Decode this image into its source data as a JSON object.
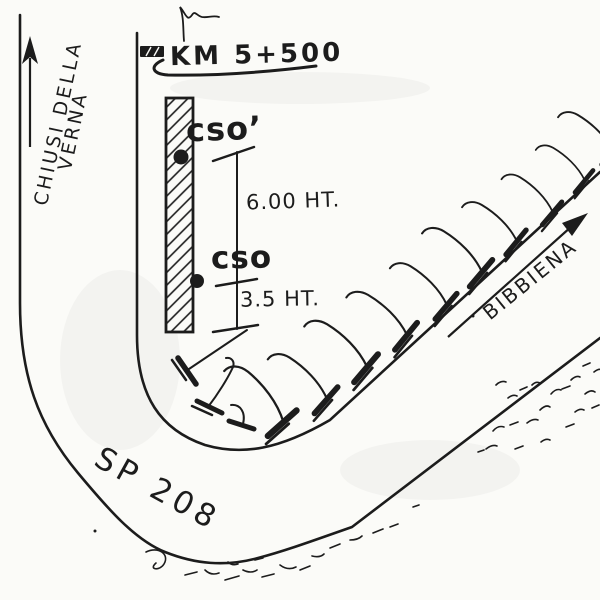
{
  "sketch": {
    "labels": {
      "km_marker": "KM 5+500",
      "cso_prime": "cso’",
      "cso": "cso",
      "dim_upper": "6.00 HT.",
      "dim_lower": "3.5 HT.",
      "dest_left_line1": "CHIUSI DELLA",
      "dest_left_line2": "VERNA",
      "dest_right": "BIBBIENA",
      "road_name": "SP 208"
    },
    "icons": {
      "direction_arrow_left": "up-arrow",
      "direction_arrow_right": "up-right-arrow",
      "km_marker_stone": "dark-hatched-rect",
      "guardrail_post": "flared-post-symbol",
      "survey_flag": "squiggle-flag",
      "wall": "diagonal-hatched-bar",
      "measure_points": "filled-dots"
    },
    "colors": {
      "ink": "#1c1c1c",
      "paper": "#fbfbf8"
    }
  }
}
